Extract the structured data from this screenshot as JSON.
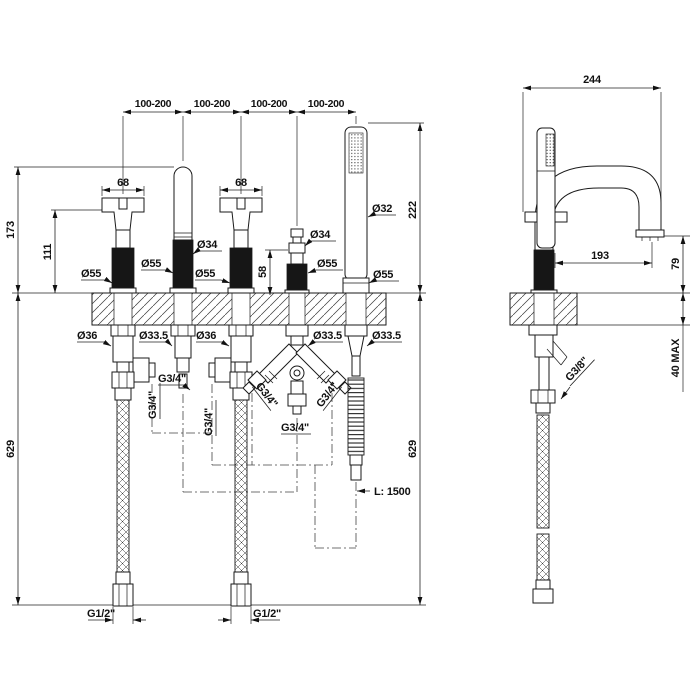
{
  "front": {
    "spacing": [
      "100-200",
      "100-200",
      "100-200",
      "100-200"
    ],
    "handle_width_left": "68",
    "handle_width_right": "68",
    "total_height": "173",
    "handle_height": "111",
    "shower_height": "222",
    "diverter_height": "58",
    "drop_left": "629",
    "drop_right": "629",
    "dia_handle_left": "Ø55",
    "dia_spout": "Ø34",
    "dia_spout_base": "Ø55",
    "dia_handle_right": "Ø55",
    "dia_diverter": "Ø34",
    "dia_diverter_base": "Ø55",
    "dia_shower": "Ø32",
    "dia_shower_base": "Ø55",
    "hole_handle_left": "Ø36",
    "hole_spout": "Ø33.5",
    "hole_handle_right": "Ø36",
    "hole_diverter": "Ø33.5",
    "hole_shower": "Ø33.5",
    "thread_valve_left": "G3/4\"",
    "thread_spout": "G3/4\"",
    "thread_valve_right": "G3/4\"",
    "thread_diverter_left": "G3/4\"",
    "thread_diverter_right": "G3/4\"",
    "thread_diverter_outlet": "G3/4\"",
    "supply_left": "G1/2\"",
    "supply_right": "G1/2\"",
    "hose_length": "L: 1500"
  },
  "side": {
    "depth": "244",
    "reach": "193",
    "spout_height": "79",
    "deck_thickness": "40 MAX",
    "supply_thread": "G3/8\""
  },
  "colors": {
    "line": "#1a1a1a",
    "background": "#ffffff"
  }
}
